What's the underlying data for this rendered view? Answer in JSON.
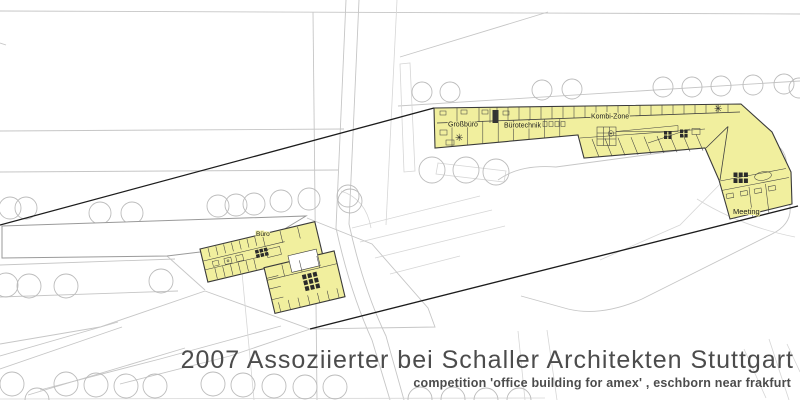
{
  "plan_labels": {
    "grossbuero": "Großbüro",
    "buerotechnik": "Bürotechnik",
    "kombi_zone": "Kombi-Zone",
    "meeting": "Meeting",
    "buero": "Büro"
  },
  "icons": {
    "sun": "✳"
  },
  "colors": {
    "highlight_fill": "#f1ef9e",
    "building_outline": "#3a3a3a",
    "site_line": "#c6c6c6",
    "tree_line": "#bcbcbc",
    "connector_line": "#1c1c1c",
    "caption_text": "#4c4c4c"
  },
  "caption": {
    "line1": "2007 Assoziierter bei Schaller Architekten Stuttgart",
    "line2": "competition 'office building for amex' , eschborn near frakfurt"
  }
}
